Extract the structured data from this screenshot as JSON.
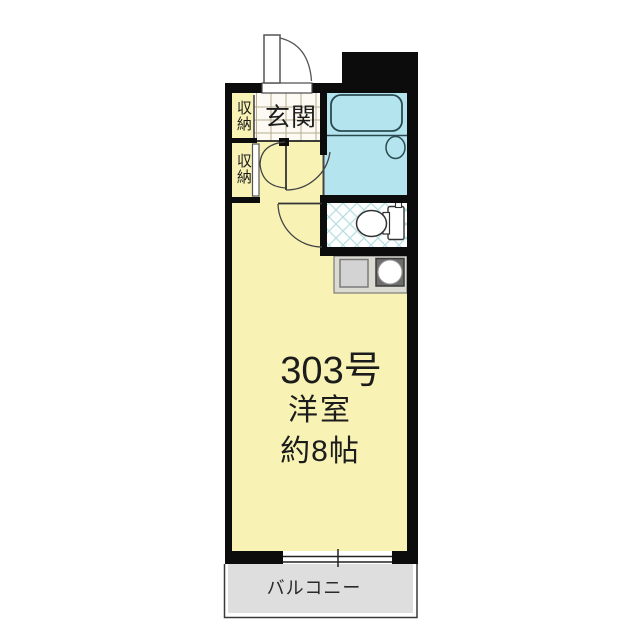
{
  "floorplan": {
    "unit_number": "303号",
    "main_room": {
      "type_label": "洋室",
      "area_label": "約8帖"
    },
    "entrance_label": "玄関",
    "storage_upper_label": "収納",
    "storage_lower_label": "収納",
    "balcony_label": "バルコニー"
  },
  "colors": {
    "wall": "#0c0c0c",
    "room_fill": "#f8f3b4",
    "bathroom_fill": "#b4e5ee",
    "toilet_tile_line": "#b7dde2",
    "entrance_tile_line": "#b6ad92",
    "kitchen_counter_fill": "#dbdbd1",
    "stove_fill": "#6d6d6d",
    "balcony_fill": "#dedede",
    "background": "#ffffff"
  }
}
